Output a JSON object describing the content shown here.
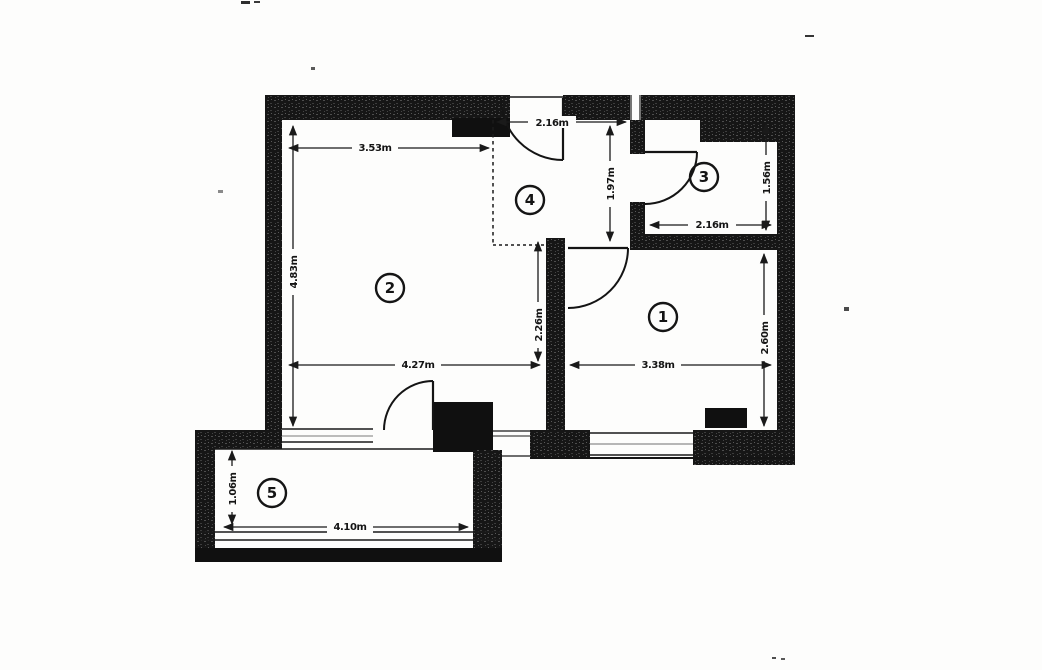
{
  "plan": {
    "kind": "apartment-floor-plan",
    "rooms": [
      {
        "label": "1",
        "width": "3.38m",
        "depth": "2.60m"
      },
      {
        "label": "2",
        "width": "4.27m",
        "depth": "4.83m",
        "top_width": "3.53m",
        "inner_wall": "2.26m"
      },
      {
        "label": "3",
        "width": "2.16m",
        "depth": "1.56m"
      },
      {
        "label": "4",
        "entry_width": "2.16m",
        "depth": "1.97m"
      },
      {
        "label": "5",
        "width": "4.10m",
        "depth": "1.06m"
      }
    ],
    "colors": {
      "paper": "#fdfdfc",
      "wall": "#161616",
      "line": "#1a1a1a"
    }
  }
}
